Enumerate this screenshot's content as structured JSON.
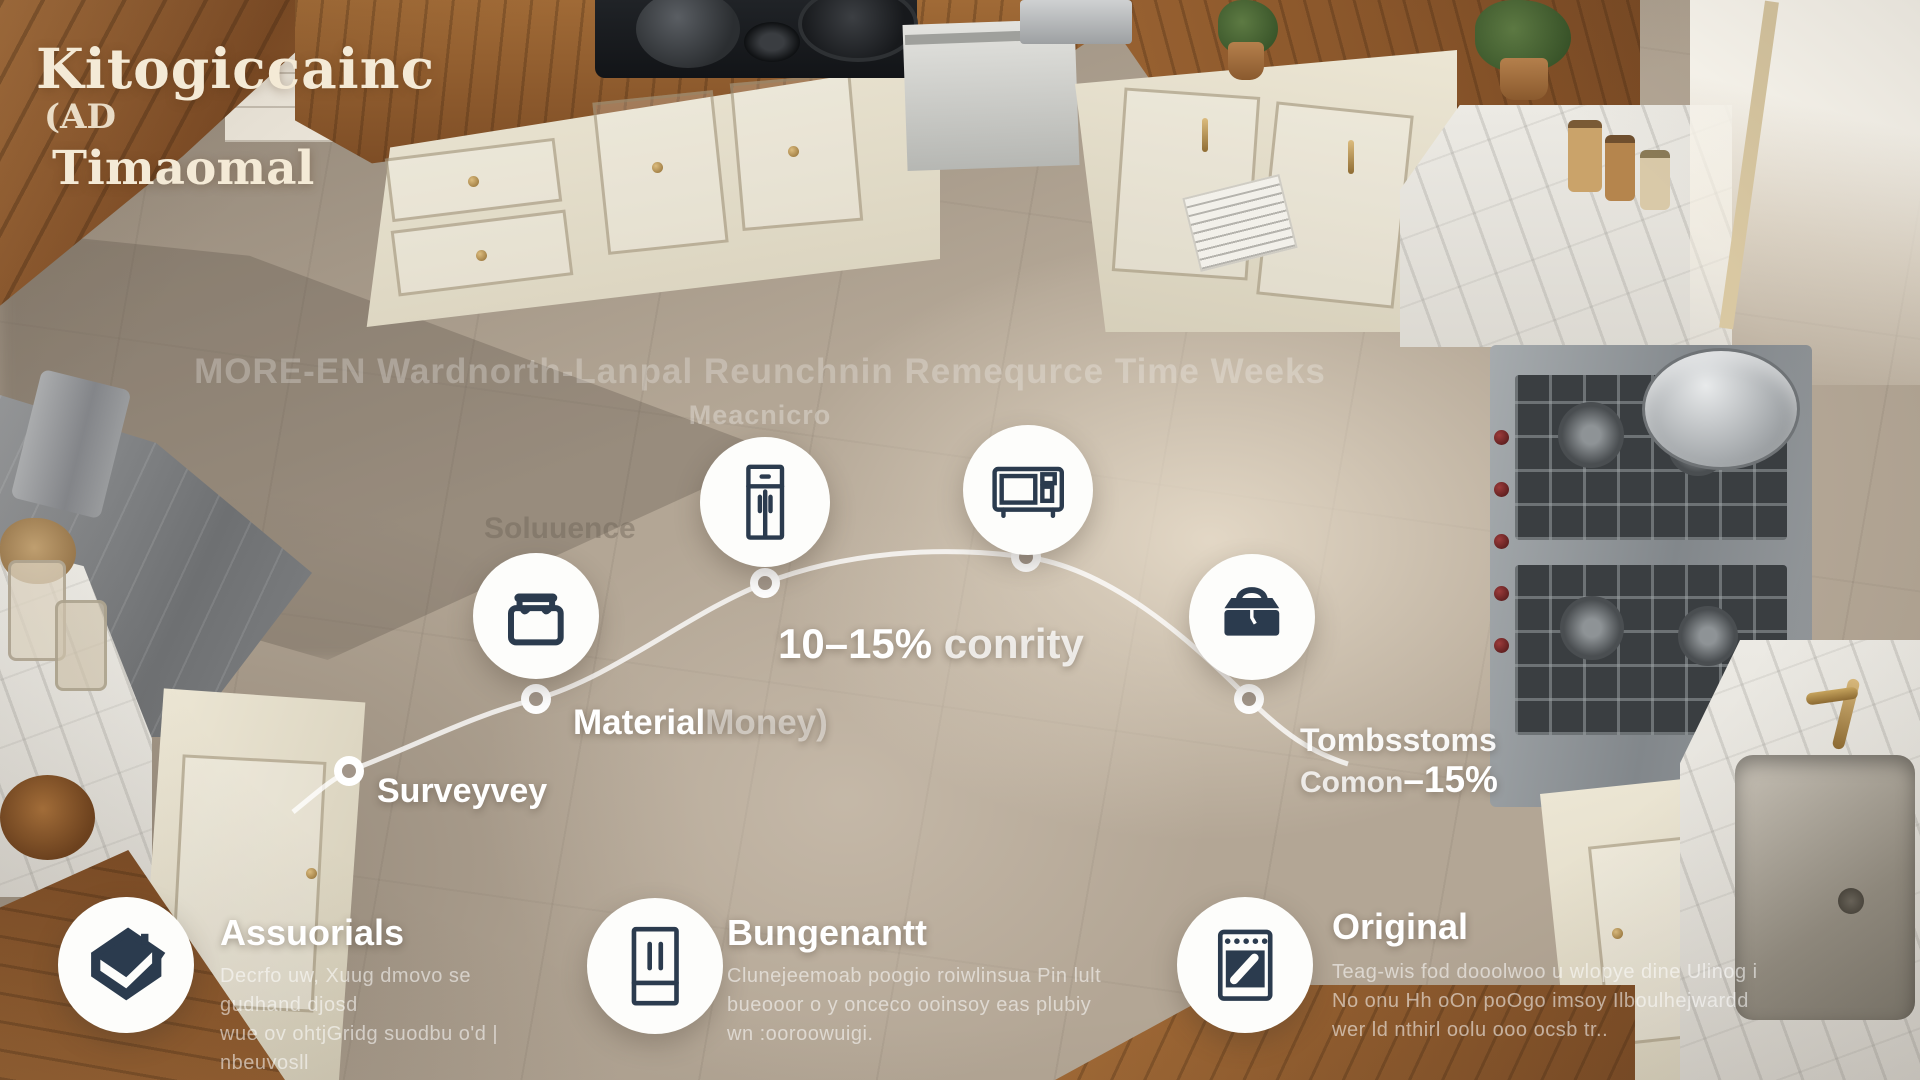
{
  "title": {
    "line1": "Kitogiccainc",
    "line2": "(AD",
    "line3": "Timaomal"
  },
  "watermark": {
    "line1": "MORE-EN Wardnorth-Lanpal Reunchnin Remequrce Time Weeks",
    "line2": "Meacnicro",
    "ghost": "Soluuence"
  },
  "timeline": {
    "stage1": {
      "label": "Surveyvey",
      "icon": "tool-bag-icon"
    },
    "stage2": {
      "label": "Material",
      "label_faint": "Money)",
      "icon": "refrigerator-icon"
    },
    "stage3": {
      "label_bold": "10–15%",
      "label_rest": " conrity",
      "icon": "microwave-icon"
    },
    "stage4": {
      "line1": "Tombsstoms",
      "line2": "Comon",
      "line2_bold": "–15%",
      "icon": "toolbox-icon"
    }
  },
  "legend": {
    "items": [
      {
        "icon": "house-icon",
        "title": "Assuorials",
        "desc": [
          "Decrfo uw, Xuug dmovo se gudhand djosd",
          "wue ov ohtjGridg suodbu o'd | nbeuvosll",
          "wuun  ssoo u  oo owsst foxoldsi."
        ]
      },
      {
        "icon": "french-door-fridge-icon",
        "title": "Bungenantt",
        "desc": [
          "Clunejeemoab poogio roiwlinsua Pin lult",
          "bueooor o y onceco ooinsoy eas plubiy",
          "wn :ooroowuigi."
        ]
      },
      {
        "icon": "oven-icon",
        "title": "Original",
        "desc": [
          "Teag-wis fod dooolwoo u wlopye dine Ulinog i",
          "No onu Hh oOn poOgo imsoy Ilboulhejwardd",
          "wer ld nthirl oolu ooo ocsb tr.."
        ]
      }
    ]
  },
  "colors": {
    "accent_navy": "#2b3b4e",
    "title_cream": "#f4ead6",
    "path_white": "#ffffff",
    "floor_beige": "#b3a695"
  }
}
